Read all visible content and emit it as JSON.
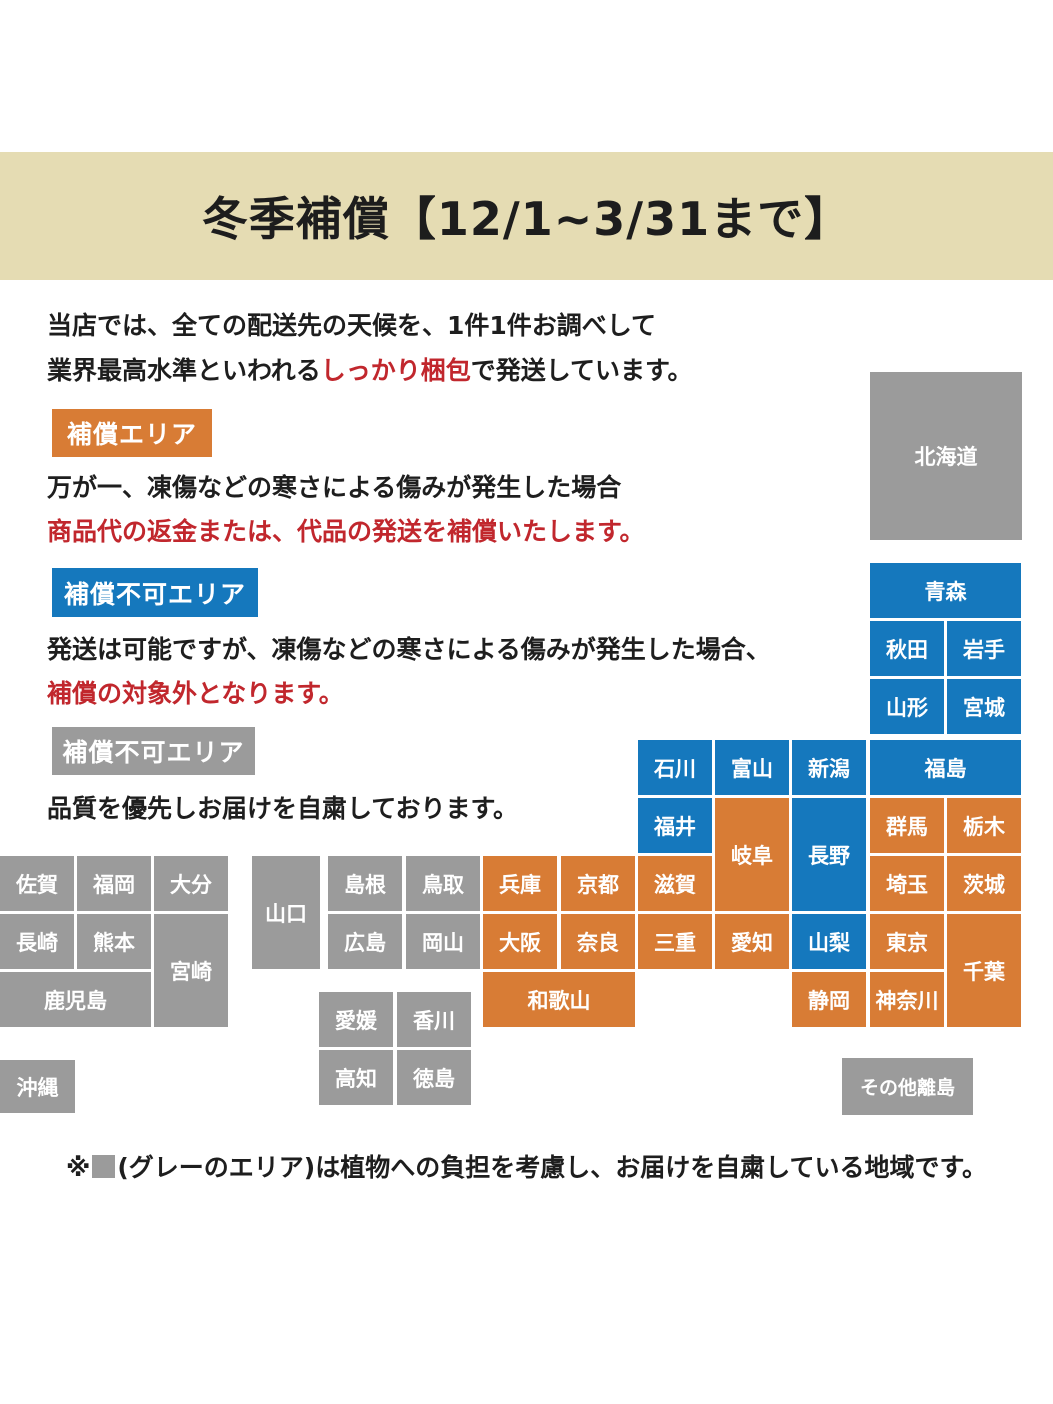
{
  "header": {
    "title": "冬季補償【12/1~3/31まで】"
  },
  "intro": {
    "line1": "当店では、全ての配送先の天候を、1件1件お調べして",
    "line2_pre": "業界最高水準といわれる",
    "line2_em": "しっかり梱包",
    "line2_post": "で発送しています。"
  },
  "sections": [
    {
      "badge": "補償エリア",
      "badge_color": "#d87c35",
      "line1": "万が一、凍傷などの寒さによる傷みが発生した場合",
      "line2": "商品代の返金または、代品の発送を補償いたします。"
    },
    {
      "badge": "補償不可エリア",
      "badge_color": "#1578bd",
      "line1": "発送は可能ですが、凍傷などの寒さによる傷みが発生した場合、",
      "line2": "補償の対象外となります。"
    },
    {
      "badge": "補償不可エリア",
      "badge_color": "#9b9b9b",
      "line1": "品質を優先しお届けを自粛しております。"
    }
  ],
  "map": {
    "colors": {
      "gray": "#9b9b9b",
      "blue": "#1578bd",
      "orange": "#d87c35"
    },
    "legend_meaning": {
      "orange": "補償エリア",
      "blue": "補償不可エリア",
      "gray": "お届け自粛エリア"
    },
    "cells": [
      {
        "label": "北海道",
        "c": "gray",
        "x": 870,
        "y": 372,
        "w": 152,
        "h": 168
      },
      {
        "label": "青森",
        "c": "blue",
        "x": 870,
        "y": 563,
        "w": 151,
        "h": 55
      },
      {
        "label": "秋田",
        "c": "blue",
        "x": 870,
        "y": 621,
        "w": 74,
        "h": 55
      },
      {
        "label": "岩手",
        "c": "blue",
        "x": 947,
        "y": 621,
        "w": 74,
        "h": 55
      },
      {
        "label": "山形",
        "c": "blue",
        "x": 870,
        "y": 679,
        "w": 74,
        "h": 55
      },
      {
        "label": "宮城",
        "c": "blue",
        "x": 947,
        "y": 679,
        "w": 74,
        "h": 55
      },
      {
        "label": "石川",
        "c": "blue",
        "x": 638,
        "y": 740,
        "w": 74,
        "h": 55
      },
      {
        "label": "富山",
        "c": "blue",
        "x": 715,
        "y": 740,
        "w": 74,
        "h": 55
      },
      {
        "label": "新潟",
        "c": "blue",
        "x": 792,
        "y": 740,
        "w": 74,
        "h": 55
      },
      {
        "label": "福島",
        "c": "blue",
        "x": 870,
        "y": 740,
        "w": 151,
        "h": 55
      },
      {
        "label": "福井",
        "c": "blue",
        "x": 638,
        "y": 798,
        "w": 74,
        "h": 55
      },
      {
        "label": "岐阜",
        "c": "orange",
        "x": 715,
        "y": 798,
        "w": 74,
        "h": 113
      },
      {
        "label": "長野",
        "c": "blue",
        "x": 792,
        "y": 798,
        "w": 74,
        "h": 113
      },
      {
        "label": "群馬",
        "c": "orange",
        "x": 870,
        "y": 798,
        "w": 74,
        "h": 55
      },
      {
        "label": "栃木",
        "c": "orange",
        "x": 947,
        "y": 798,
        "w": 74,
        "h": 55
      },
      {
        "label": "兵庫",
        "c": "orange",
        "x": 483,
        "y": 856,
        "w": 74,
        "h": 55
      },
      {
        "label": "京都",
        "c": "orange",
        "x": 561,
        "y": 856,
        "w": 74,
        "h": 55
      },
      {
        "label": "滋賀",
        "c": "orange",
        "x": 638,
        "y": 856,
        "w": 74,
        "h": 55
      },
      {
        "label": "埼玉",
        "c": "orange",
        "x": 870,
        "y": 856,
        "w": 74,
        "h": 55
      },
      {
        "label": "茨城",
        "c": "orange",
        "x": 947,
        "y": 856,
        "w": 74,
        "h": 55
      },
      {
        "label": "大阪",
        "c": "orange",
        "x": 483,
        "y": 914,
        "w": 74,
        "h": 55
      },
      {
        "label": "奈良",
        "c": "orange",
        "x": 561,
        "y": 914,
        "w": 74,
        "h": 55
      },
      {
        "label": "三重",
        "c": "orange",
        "x": 638,
        "y": 914,
        "w": 74,
        "h": 55
      },
      {
        "label": "愛知",
        "c": "orange",
        "x": 715,
        "y": 914,
        "w": 74,
        "h": 55
      },
      {
        "label": "山梨",
        "c": "blue",
        "x": 792,
        "y": 914,
        "w": 74,
        "h": 55
      },
      {
        "label": "東京",
        "c": "orange",
        "x": 870,
        "y": 914,
        "w": 74,
        "h": 55
      },
      {
        "label": "千葉",
        "c": "orange",
        "x": 947,
        "y": 914,
        "w": 74,
        "h": 113
      },
      {
        "label": "和歌山",
        "c": "orange",
        "x": 483,
        "y": 972,
        "w": 152,
        "h": 55
      },
      {
        "label": "静岡",
        "c": "orange",
        "x": 792,
        "y": 972,
        "w": 74,
        "h": 55
      },
      {
        "label": "神奈川",
        "c": "orange",
        "x": 870,
        "y": 972,
        "w": 74,
        "h": 55
      },
      {
        "label": "佐賀",
        "c": "gray",
        "x": 0,
        "y": 856,
        "w": 74,
        "h": 55
      },
      {
        "label": "福岡",
        "c": "gray",
        "x": 77,
        "y": 856,
        "w": 74,
        "h": 55
      },
      {
        "label": "大分",
        "c": "gray",
        "x": 154,
        "y": 856,
        "w": 74,
        "h": 55
      },
      {
        "label": "長崎",
        "c": "gray",
        "x": 0,
        "y": 914,
        "w": 74,
        "h": 55
      },
      {
        "label": "熊本",
        "c": "gray",
        "x": 77,
        "y": 914,
        "w": 74,
        "h": 55
      },
      {
        "label": "宮崎",
        "c": "gray",
        "x": 154,
        "y": 914,
        "w": 74,
        "h": 113
      },
      {
        "label": "鹿児島",
        "c": "gray",
        "x": 0,
        "y": 972,
        "w": 151,
        "h": 55
      },
      {
        "label": "山口",
        "c": "gray",
        "x": 252,
        "y": 856,
        "w": 68,
        "h": 113
      },
      {
        "label": "島根",
        "c": "gray",
        "x": 328,
        "y": 856,
        "w": 74,
        "h": 55
      },
      {
        "label": "鳥取",
        "c": "gray",
        "x": 406,
        "y": 856,
        "w": 74,
        "h": 55
      },
      {
        "label": "広島",
        "c": "gray",
        "x": 328,
        "y": 914,
        "w": 74,
        "h": 55
      },
      {
        "label": "岡山",
        "c": "gray",
        "x": 406,
        "y": 914,
        "w": 74,
        "h": 55
      },
      {
        "label": "愛媛",
        "c": "gray",
        "x": 319,
        "y": 992,
        "w": 74,
        "h": 55
      },
      {
        "label": "香川",
        "c": "gray",
        "x": 397,
        "y": 992,
        "w": 74,
        "h": 55
      },
      {
        "label": "高知",
        "c": "gray",
        "x": 319,
        "y": 1050,
        "w": 74,
        "h": 55
      },
      {
        "label": "徳島",
        "c": "gray",
        "x": 397,
        "y": 1050,
        "w": 74,
        "h": 55
      },
      {
        "label": "沖縄",
        "c": "gray",
        "x": 0,
        "y": 1060,
        "w": 75,
        "h": 53
      },
      {
        "label": "その他離島",
        "c": "gray",
        "x": 842,
        "y": 1058,
        "w": 131,
        "h": 57
      }
    ]
  },
  "footnote": {
    "prefix": "※",
    "square_icon_color": "#9b9b9b",
    "text": "(グレーのエリア)は植物への負担を考慮し、お届けを自粛している地域です。"
  }
}
